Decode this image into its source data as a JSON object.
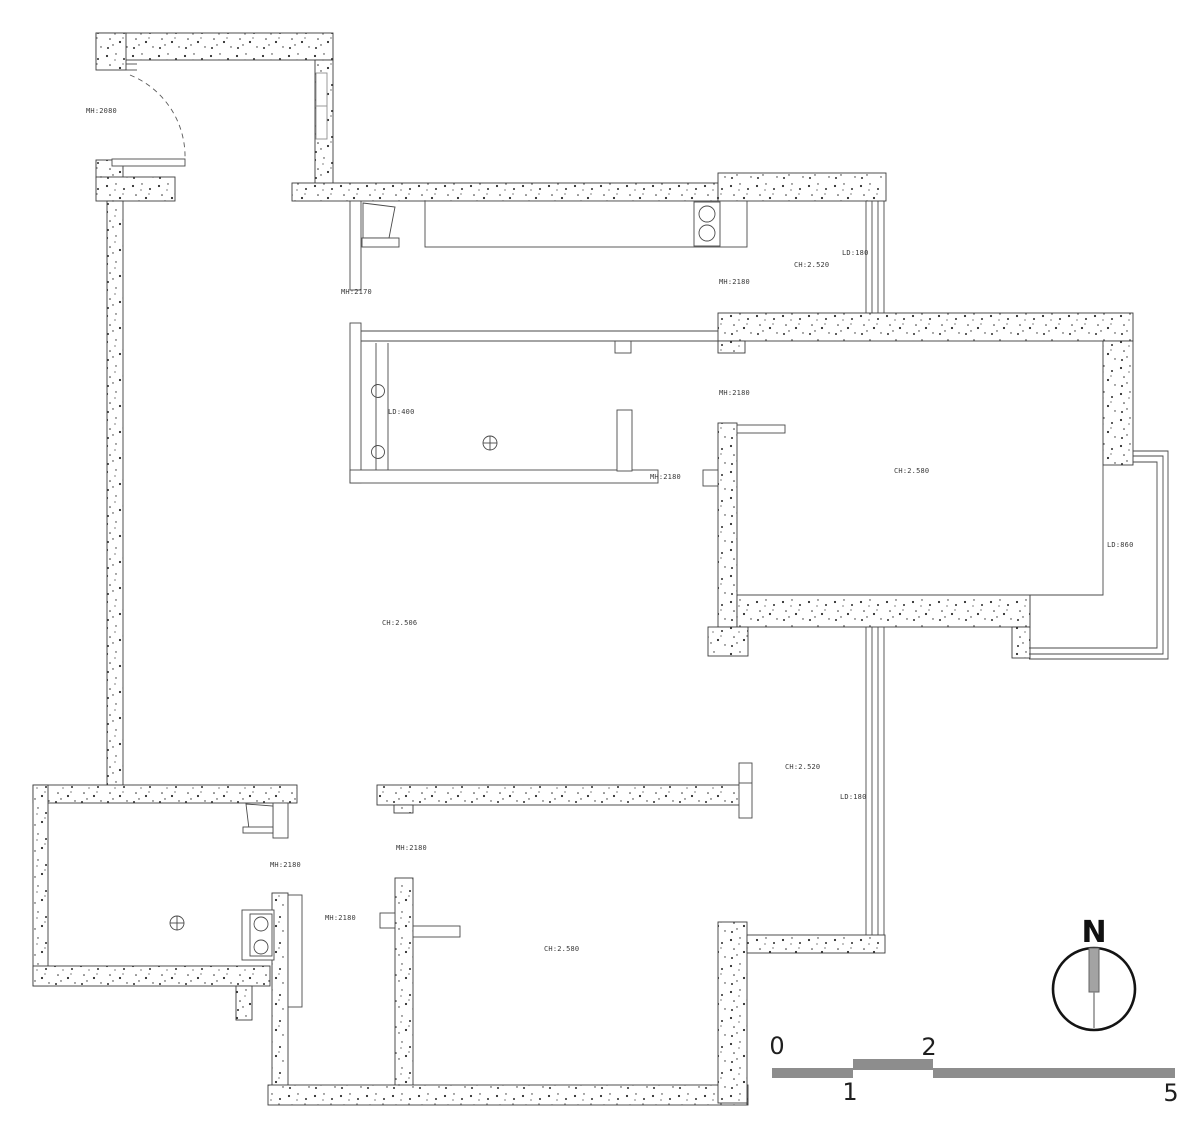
{
  "labels": {
    "entry_door_height": "MH:2080",
    "kitchen_door_height": "MH:2170",
    "dining_ceiling_top": "CH:2.520",
    "window_sill_top": "LD:180",
    "door_height_top": "MH:2180",
    "bath_window_sill": "LD:400",
    "bedroom_door_height": "MH:2180",
    "bedroom_ceiling": "CH:2.580",
    "bay_window_sill": "LD:860",
    "corridor_door_height": "MH:2180",
    "living_ceiling": "CH:2.506",
    "dining_ceiling_bottom": "CH:2.520",
    "window_sill_bottom": "LD:180",
    "bottom_center_door_height": "MH:2180",
    "bottom_left_door_height": "MH:2180",
    "hall_door_height": "MH:2180",
    "bottom_room_ceiling": "CH:2.580"
  },
  "compass": {
    "north": "N"
  },
  "scale_bar": {
    "tick_0": "0",
    "tick_1": "1",
    "tick_2": "2",
    "tick_5": "5"
  },
  "colors": {
    "wall_line": "#3c3c3c",
    "speckle": "#2b2b2b",
    "scale_bar_fill": "#8d8d8d",
    "background": "#ffffff"
  }
}
